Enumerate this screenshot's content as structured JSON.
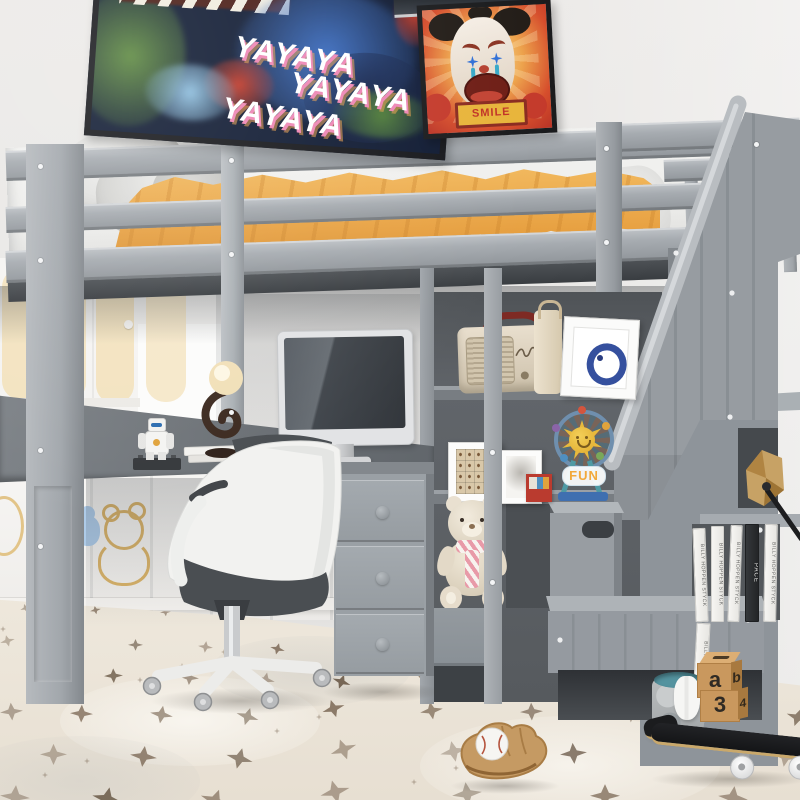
{
  "scene": {
    "title": "Gray twin loft bed with L-shaped desk, office chair, storage staircase and shelves in a kids room"
  },
  "posters": {
    "graffiti": {
      "lines": [
        "YAYAYA",
        "YAYAYA",
        "YAYAYA"
      ]
    },
    "clown": {
      "sign_text": "SMILE"
    }
  },
  "shelf_items": {
    "ferris_wheel_label": "FUN"
  },
  "books": {
    "spine_text": "BILLY HOPPEN STYCK",
    "dark_spine_text": "PACE"
  },
  "toy_blocks": {
    "faces": [
      "a",
      "b",
      "3",
      "4"
    ]
  },
  "colors": {
    "frame_gray": "#9aa0a5",
    "back_panel": "#5c6064",
    "blanket_orange": "#e8a243",
    "basket_teal": "#54939f",
    "block_wood": "#c9985e",
    "rug_base": "#ece5d9",
    "rug_star": "#6f5a46",
    "handrail": "#bcc0c4"
  }
}
